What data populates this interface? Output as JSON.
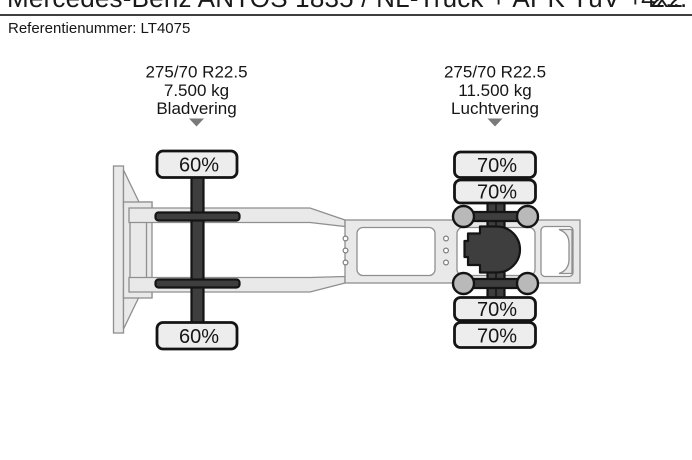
{
  "header": {
    "title": "Mercedes-Benz ANTOS 1835 / NL-Truck + APK TüV + 2...",
    "drive_config": "4x2",
    "reference": "Referentienummer: LT4075"
  },
  "diagram": {
    "front_axle": {
      "tyre_size": "275/70 R22.5",
      "axle_load": "7.500 kg",
      "suspension": "Bladvering",
      "tyres": [
        "60%",
        "60%"
      ]
    },
    "rear_axle": {
      "tyre_size": "275/70 R22.5",
      "axle_load": "11.500 kg",
      "suspension": "Luchtvering",
      "tyres": [
        "70%",
        "70%",
        "70%",
        "70%"
      ]
    }
  },
  "colors": {
    "background": "#ffffff",
    "frame_fill": "#e9e9e9",
    "frame_stroke": "#8f8f8f",
    "mechanical_dark": "#3e3e3e",
    "outline_black": "#141414",
    "tyre_fill": "#ededed",
    "bellow_fill": "#b9b9b9",
    "arrow_gray": "#7a7a7a",
    "text": "#161616"
  }
}
